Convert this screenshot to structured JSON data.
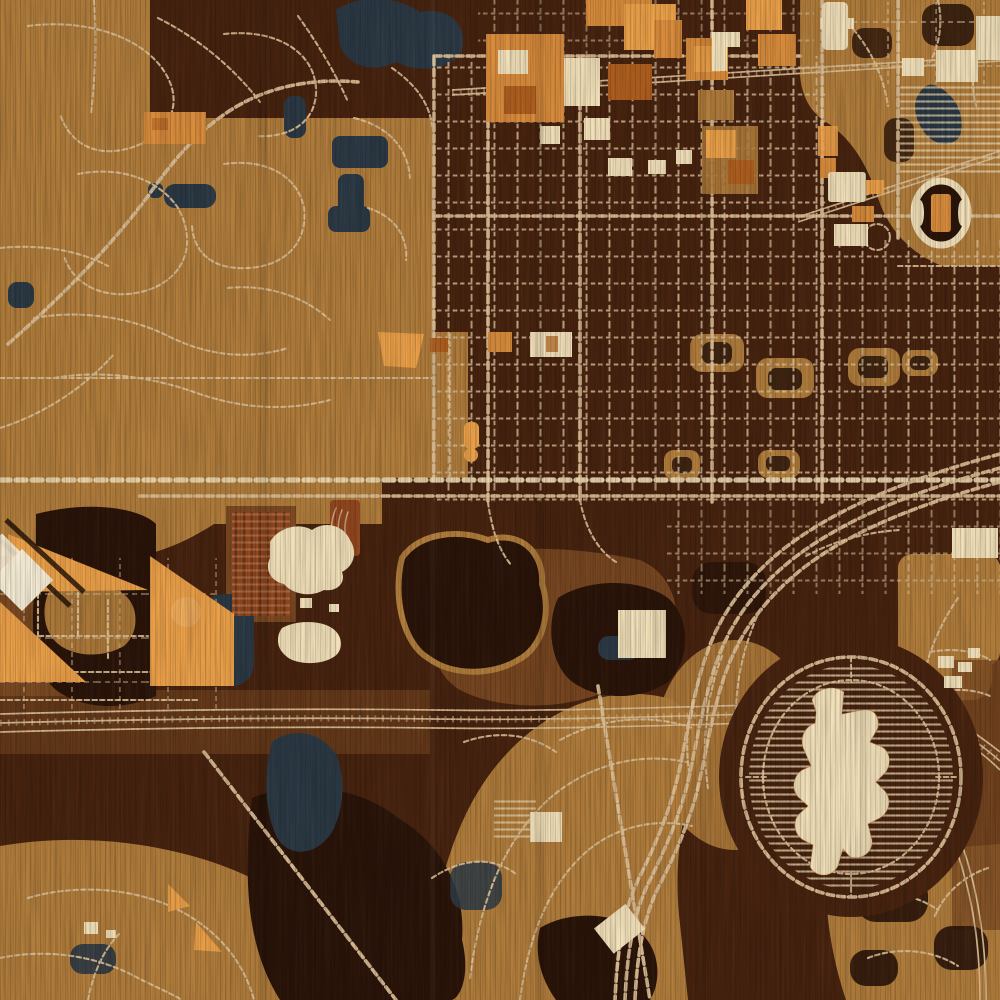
{
  "meta": {
    "label": "Engraved wood-style city street map",
    "style": "laser-etched wood map, no visible text labels"
  },
  "palette": {
    "base_dark": "#47230f",
    "wood_shadow": "#2e1406",
    "tan": "#b17d3c",
    "tan_light": "#c89a5f",
    "medium": "#7c4a22",
    "forest": "#2a1409",
    "forest_deep": "#1c0d04",
    "orange": "#d98c3c",
    "orange_bright": "#eca149",
    "orange_deep": "#b05f1e",
    "brick": "#93471f",
    "cream": "#f2e1ba",
    "cream_bright": "#f8efd8",
    "road": "#dcc098",
    "road_bright": "#e9d6ae",
    "water": "#2b3945",
    "water_deep": "#18222b",
    "glow": "#f2b469"
  },
  "features": {
    "west_suburbs": "tan suburban street curves",
    "downtown_grid": "dense dark urban street grid",
    "commercial_district": "orange and cream building blocks, top center",
    "campus_stadium": "stadium oval with parking rows, top right",
    "teardrop_lake": "dark teardrop pond, top right",
    "lakes": "navy ponds and lakes",
    "forest_parks": "dark wooded parcels",
    "rail_corridor": "multi-track railroad across lower third",
    "freeway_curve": "multi-lane freeway sweeping bottom right",
    "fairground_oval": "ring road with striped parking lots and large cream exhibition building",
    "mall_building": "irregular cream landmark building in oval",
    "warehouse_diamonds": "rotated cream warehouse diamonds, left edge",
    "golf_course_southeast": "tan course with dark tree blobs"
  },
  "canvas": {
    "width": 1000,
    "height": 1000
  }
}
